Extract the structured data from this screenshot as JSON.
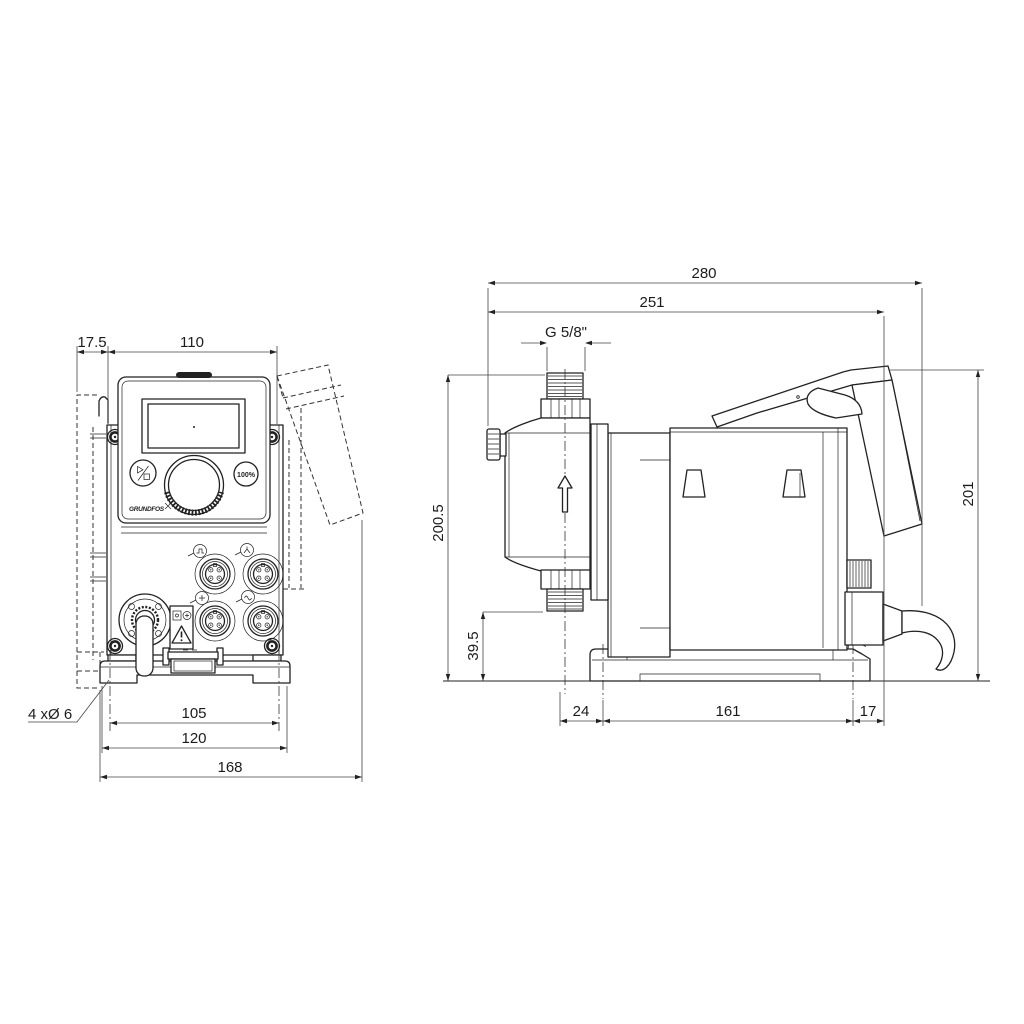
{
  "front_view": {
    "dim_wallplate_offset": "17.5",
    "dim_housing_width": "110",
    "dim_hole_note": "4 xØ 6",
    "dim_hole_spacing": "105",
    "dim_plate_width": "120",
    "dim_overall_width": "168",
    "panel": {
      "boost_button_label": "100%",
      "logo_text": "GRUNDFOS"
    }
  },
  "side_view": {
    "dim_overall_depth": "280",
    "dim_depth_to_plug_face": "251",
    "dim_connection_thread": "G 5/8\"",
    "dim_total_height": "200.5",
    "dim_suction_valve_height": "39.5",
    "dim_hood_height": "201",
    "dim_center_to_front_hole": "24",
    "dim_base_hole_spacing": "161",
    "dim_rear_offset": "17"
  }
}
